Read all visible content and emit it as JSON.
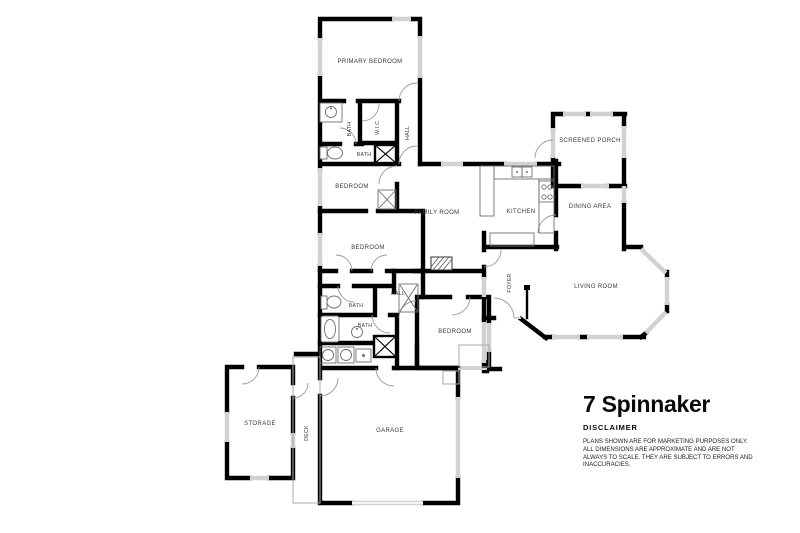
{
  "plan": {
    "rooms": {
      "primary_bedroom": "PRIMARY BEDROOM",
      "bath_primary": "BATH",
      "wic": "W.I.C.",
      "hall_upper": "HALL",
      "bath_upper": "BATH",
      "bedroom_1": "BEDROOM",
      "bedroom_2": "BEDROOM",
      "family_room": "FAMILY ROOM",
      "kitchen": "KITCHEN",
      "screened_porch": "SCREENED PORCH",
      "dining_area": "DINING AREA",
      "living_room": "LIVING ROOM",
      "foyer": "FOYER",
      "hall_lower": "HALL",
      "bath_lower_1": "BATH",
      "bath_lower_2": "BATH",
      "bedroom_3": "BEDROOM",
      "storage": "STORAGE",
      "deck": "DECK",
      "garage": "GARAGE"
    },
    "colors": {
      "wall": "#000000",
      "window": "#d2d2d2",
      "label": "#3a3a3a",
      "arc": "#9a9a9a",
      "background": "#ffffff"
    }
  },
  "title_block": {
    "title": "7 Spinnaker",
    "disclaimer_heading": "DISCLAIMER",
    "disclaimer_lines": [
      "PLANS SHOWN ARE FOR MARKETING PURPOSES ONLY.",
      "ALL DIMENSIONS ARE APPROXIMATE AND ARE NOT",
      "ALWAYS TO SCALE. THEY ARE SUBJECT TO ERRORS AND",
      "INACCURACIES."
    ]
  }
}
